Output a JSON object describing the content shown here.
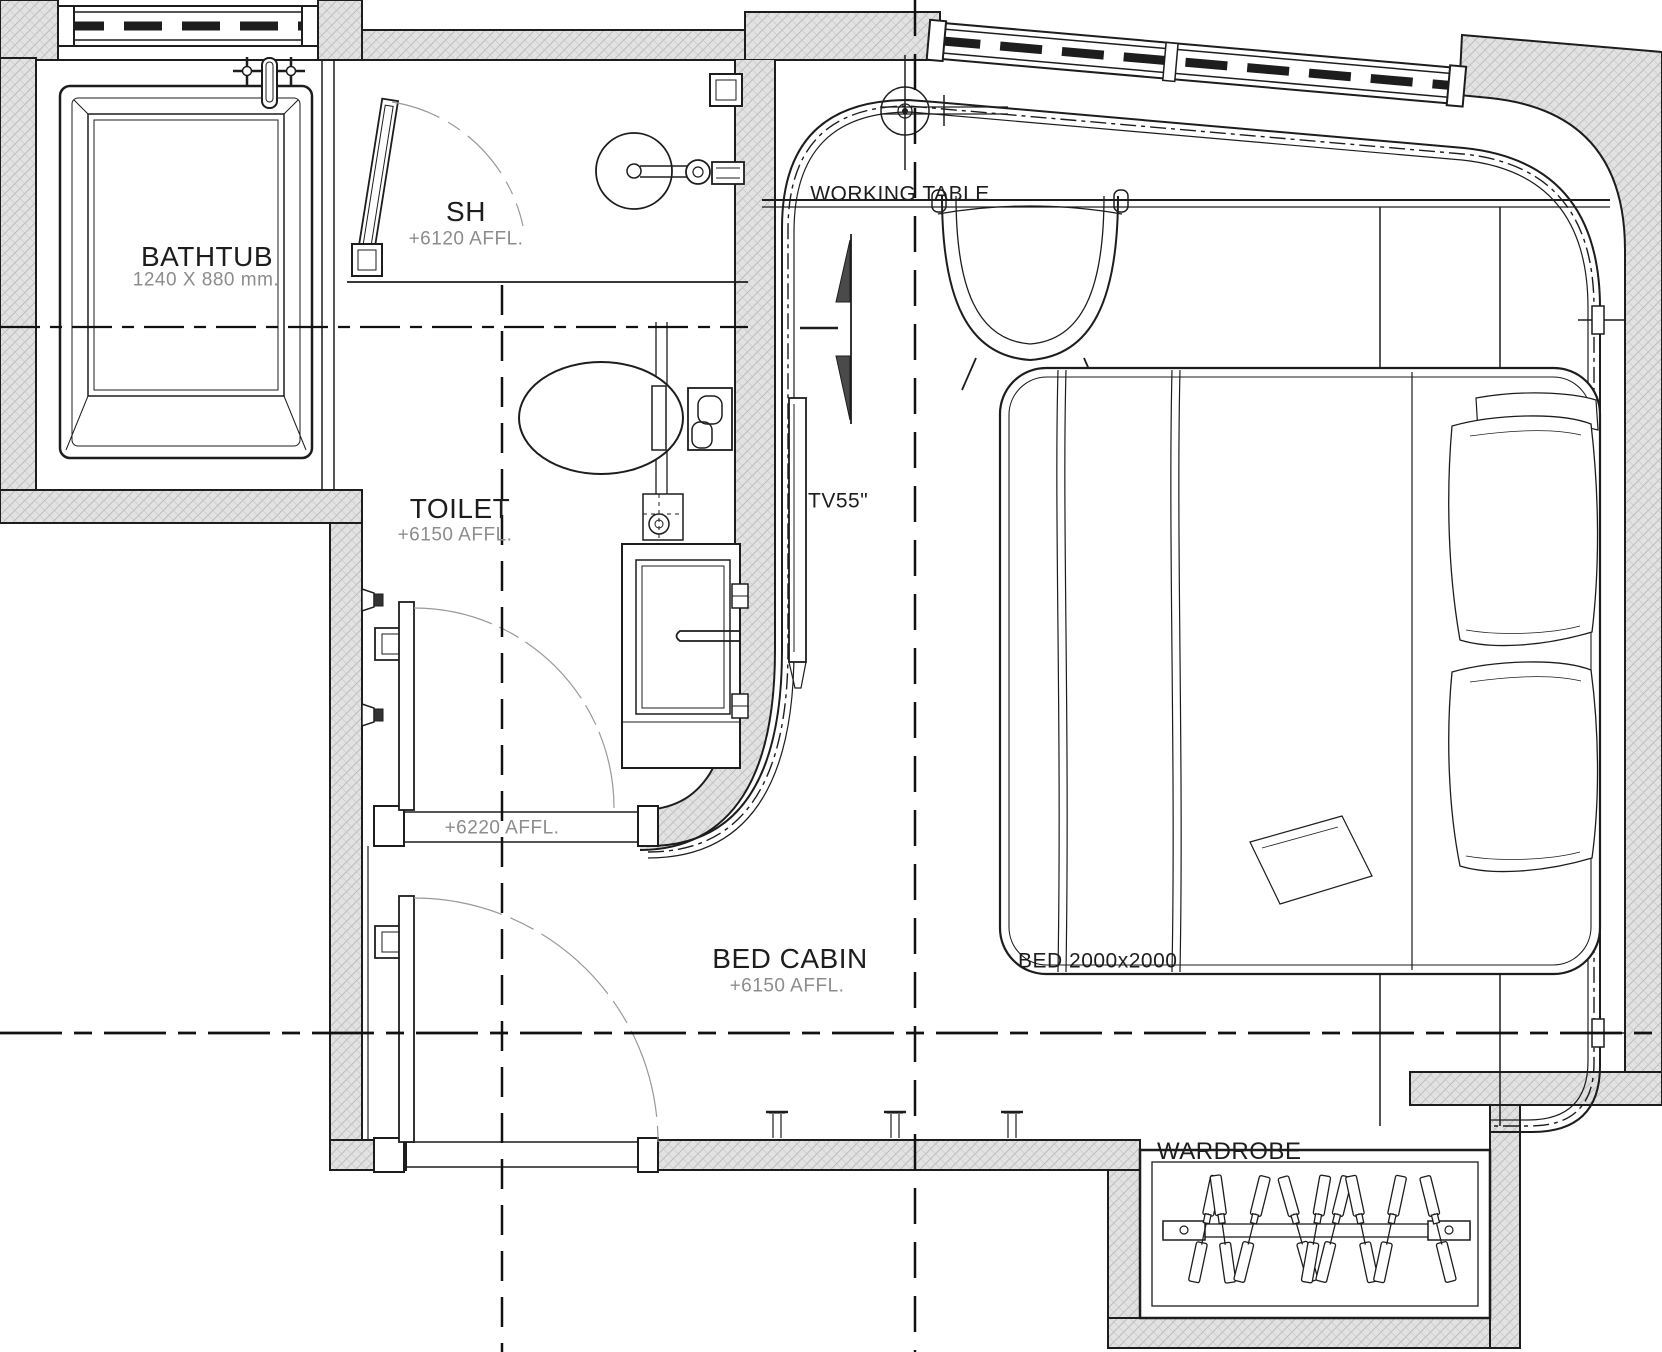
{
  "colors": {
    "line": "#1d1d1d",
    "wall_fill": "#e2e2e2",
    "hatch_line": "#b3b3b3",
    "muted_text": "#8c8c8c",
    "arrow_fill": "#4a4a4a"
  },
  "rooms": {
    "bathtub": {
      "name": "BATHTUB",
      "size": "1240 X 880 mm."
    },
    "shower": {
      "name": "SH",
      "level": "+6120 AFFL."
    },
    "toilet": {
      "name": "TOILET",
      "level": "+6150 AFFL."
    },
    "bed_cabin": {
      "name": "BED CABIN",
      "level": "+6150 AFFL."
    }
  },
  "fixtures": {
    "working_table_label": "WORKING TABLE",
    "tv_label": "TV55\"",
    "bed_label": "BED 2000x2000",
    "wardrobe_label": "WARDROBE"
  },
  "annotations": {
    "door_threshold_level": "+6220 AFFL."
  }
}
